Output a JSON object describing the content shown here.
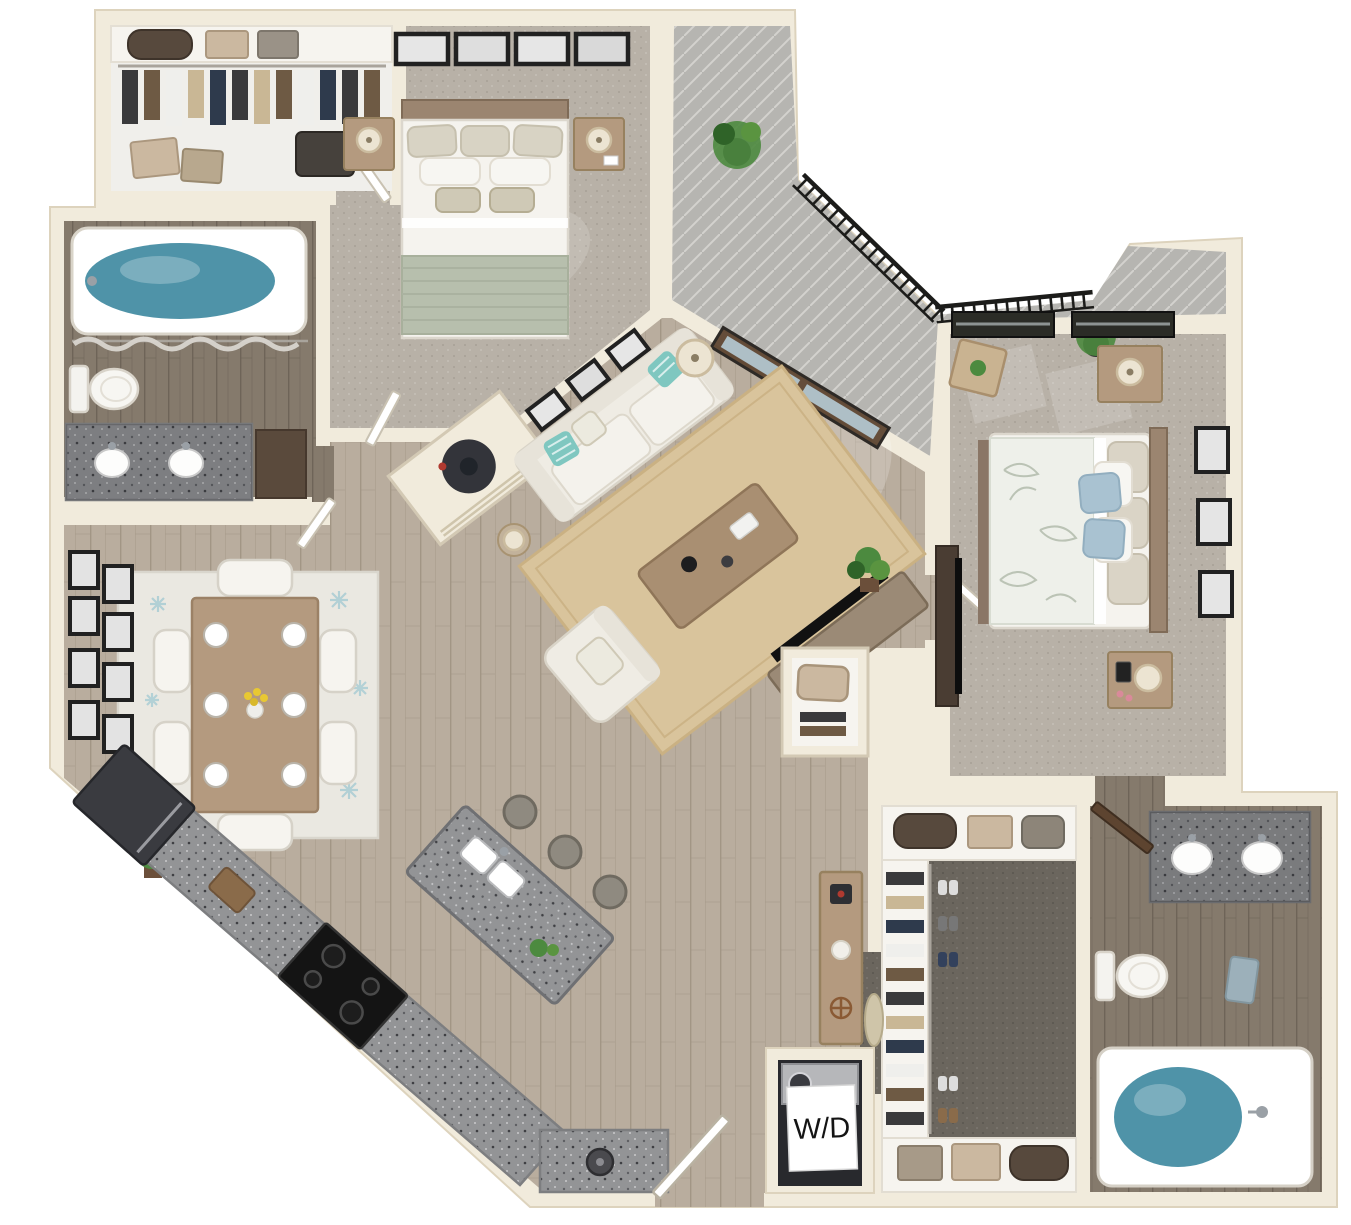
{
  "labels": {
    "washer_dryer": "W/D"
  },
  "palette": {
    "wall": "#f1ebdc",
    "wall_shade": "#ddd3bd",
    "wood": "#b9ad9e",
    "wood_line": "#a2968577",
    "carpet": "#b8b1a7",
    "carpet_dark": "#6b665e",
    "concrete": "#b6b5b1",
    "concrete_line": "#d3d2ce",
    "bath_floor": "#857a6c",
    "granite": "#939496",
    "furniture_wood": "#b49a7f",
    "white_soft": "#f6f4ef",
    "sofa": "#efece4",
    "rug_jute": "#d9c49c",
    "rug_dining": "#eae8e1",
    "rug_accent": "#a9ccd3",
    "teal": "#7fc7c0",
    "sage": "#b7bfad",
    "blue_pillow": "#a9c2d1",
    "water": "#4f93a8",
    "plant": "#4c8a3f",
    "railing": "#1c1c1a",
    "frame": "#212121",
    "door_brown": "#5d4430",
    "appliance_dark": "#33343a",
    "label_bg": "#ffffff",
    "label_text": "#141414"
  },
  "rooms": [
    {
      "id": "bedroom-1",
      "contents": [
        "bed",
        "2 nightstands",
        "2 table lamps",
        "4 framed pictures",
        "carpet"
      ]
    },
    {
      "id": "walk-in-closet-1",
      "contents": [
        "hanging clothes",
        "duffel bag",
        "storage boxes",
        "shelf"
      ]
    },
    {
      "id": "bathroom-1",
      "contents": [
        "bathtub",
        "shower curtain",
        "toilet",
        "double-sink vanity"
      ]
    },
    {
      "id": "water-heater-closet",
      "contents": [
        "water heater"
      ]
    },
    {
      "id": "living-room",
      "contents": [
        "sofa",
        "accent pillows",
        "coffee table",
        "armchair",
        "2 floor lamps",
        "jute rug",
        "3 framed pictures",
        "tv console",
        "french doors",
        "potted plant"
      ]
    },
    {
      "id": "dining-room",
      "contents": [
        "dining table",
        "6 place settings",
        "6 chairs",
        "patterned rug",
        "8 framed pictures",
        "potted plant"
      ]
    },
    {
      "id": "kitchen",
      "contents": [
        "refrigerator",
        "cooktop",
        "l-shaped counter",
        "island with double sink",
        "3 bar stools"
      ]
    },
    {
      "id": "balcony",
      "contents": [
        "metal railing",
        "2 potted plants",
        "bistro table"
      ]
    },
    {
      "id": "bedroom-2",
      "contents": [
        "bed",
        "2 nightstands",
        "2 windows",
        "3 framed pictures",
        "tv console",
        "carpet"
      ]
    },
    {
      "id": "walk-in-closet-2",
      "contents": [
        "hanging clothes",
        "shoes",
        "storage bags",
        "shelves"
      ]
    },
    {
      "id": "bathroom-2",
      "contents": [
        "double-sink vanity",
        "toilet",
        "bathtub"
      ]
    },
    {
      "id": "laundry-closet",
      "contents": [
        "washer-dryer"
      ]
    },
    {
      "id": "entry",
      "contents": [
        "open entry door",
        "console table"
      ]
    }
  ]
}
